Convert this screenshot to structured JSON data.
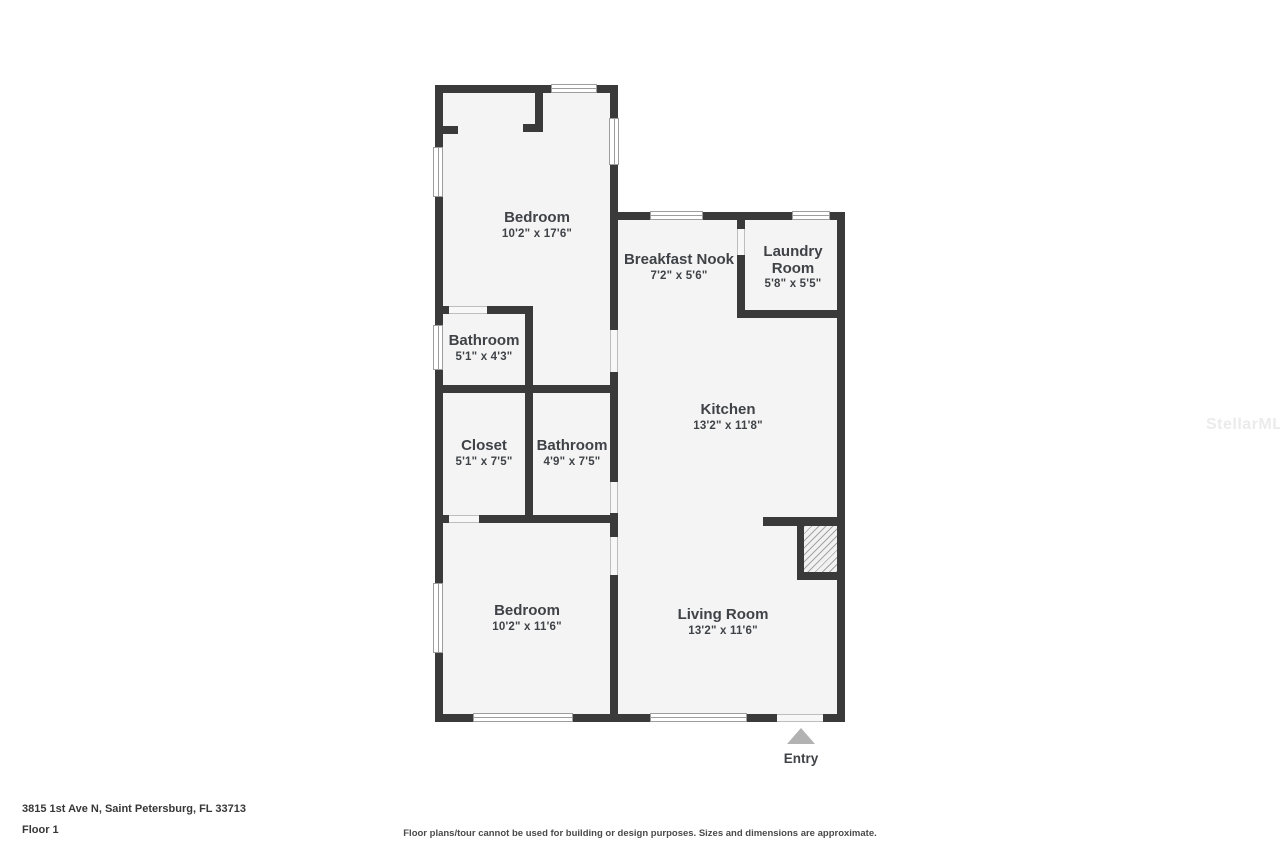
{
  "floorplan": {
    "wall_color": "#3a3a3a",
    "floor_color": "#f4f4f4",
    "label_color": "#3f4347",
    "rooms": [
      {
        "name": "Bedroom",
        "dims": "10'2\" x 17'6\""
      },
      {
        "name": "Breakfast Nook",
        "dims": "7'2\" x 5'6\""
      },
      {
        "name": "Laundry Room",
        "dims": "5'8\" x 5'5\""
      },
      {
        "name": "Bathroom",
        "dims": "5'1\" x 4'3\""
      },
      {
        "name": "Kitchen",
        "dims": "13'2\" x 11'8\""
      },
      {
        "name": "Closet",
        "dims": "5'1\" x 7'5\""
      },
      {
        "name": "Bathroom",
        "dims": "4'9\" x 7'5\""
      },
      {
        "name": "Bedroom",
        "dims": "10'2\" x 11'6\""
      },
      {
        "name": "Living Room",
        "dims": "13'2\" x 11'6\""
      }
    ],
    "entry_label": "Entry"
  },
  "footer": {
    "address": "3815 1st Ave N, Saint Petersburg, FL 33713",
    "floor_label": "Floor 1",
    "disclaimer": "Floor plans/tour cannot be used for building or design purposes. Sizes and dimensions are approximate."
  },
  "watermark": "StellarMLS"
}
